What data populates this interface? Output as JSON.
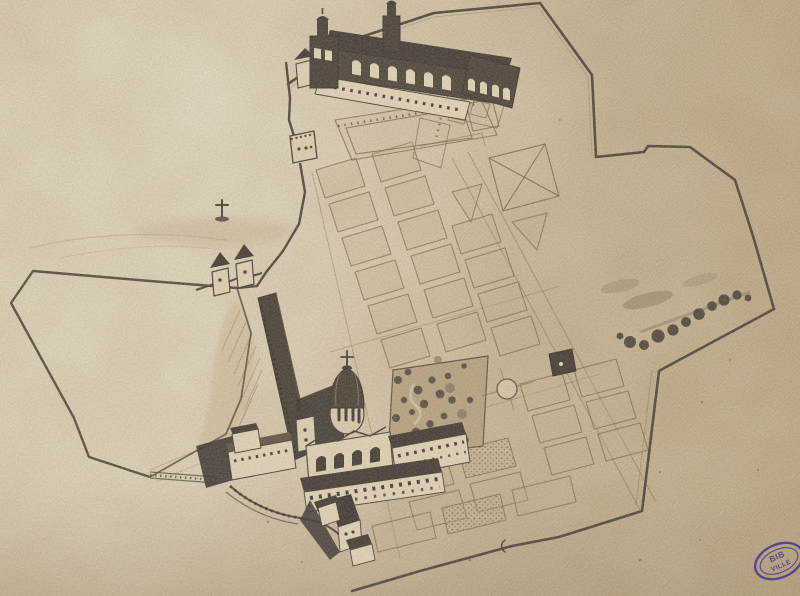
{
  "document": {
    "kind": "scanned historical bird's-eye plan drawing, sepia ink on aged paper"
  },
  "stamp": {
    "line1": "BIB",
    "line2": "VILLE",
    "shape": "oval",
    "color": "#4b3a8f"
  },
  "palette": {
    "paper": "#d8c7a6",
    "paper_light": "#efe8d4",
    "paper_tan": "#c6b28c",
    "paper_dark": "#b49f7a",
    "ink_dark": "#241a10",
    "ink_shadow": "#17100a",
    "ink_line": "#3d2f1e",
    "ink_faint": "#7b6547",
    "stamp": "#4b3a8f"
  },
  "features": [
    "boundary-wall",
    "monastery-church",
    "church-towers",
    "church-forecourt",
    "cloister-garden",
    "calvary-cross",
    "fortified-rampart",
    "bastion-tower",
    "gate-towers",
    "left-field-enclosure",
    "formal-garden-parterres",
    "x-crossed-parterre",
    "triangle-parterre",
    "bosquet-grove",
    "circular-basin",
    "garden-pavilion",
    "tree-row",
    "domed-church",
    "convent-buildings",
    "village-houses",
    "kitchen-garden-plots",
    "terrace-walls",
    "library-stamp"
  ]
}
